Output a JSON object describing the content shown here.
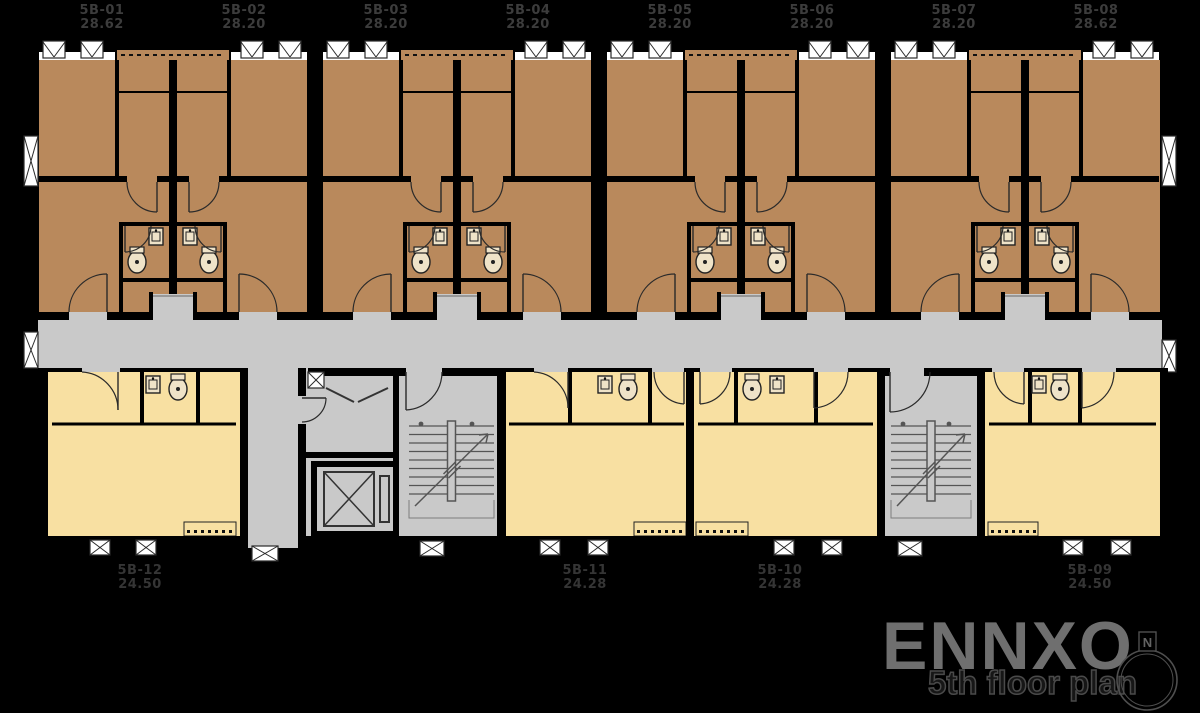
{
  "top_units": [
    {
      "id": "5B-01",
      "area": "28.62"
    },
    {
      "id": "5B-02",
      "area": "28.20"
    },
    {
      "id": "5B-03",
      "area": "28.20"
    },
    {
      "id": "5B-04",
      "area": "28.20"
    },
    {
      "id": "5B-05",
      "area": "28.20"
    },
    {
      "id": "5B-06",
      "area": "28.20"
    },
    {
      "id": "5B-07",
      "area": "28.20"
    },
    {
      "id": "5B-08",
      "area": "28.62"
    }
  ],
  "bottom_units": [
    {
      "id": "5B-12",
      "area": "24.50"
    },
    {
      "id": "5B-11",
      "area": "24.28"
    },
    {
      "id": "5B-10",
      "area": "24.28"
    },
    {
      "id": "5B-09",
      "area": "24.50"
    }
  ],
  "watermark": {
    "brand": "ENNXO",
    "caption": "5th floor plan",
    "compass_label": "N"
  },
  "colors": {
    "background": "#000000",
    "unit_top": "#b9895c",
    "unit_bottom": "#f8e0a2",
    "corridor": "#c9c9c9",
    "wall": "#000000",
    "fixture": "#efe3c8",
    "line": "#2a2a2a",
    "stair_line": "#555555",
    "label_top": "#3c3c3c",
    "label_bottom": "#353535",
    "watermark": "#6f6f6f"
  }
}
